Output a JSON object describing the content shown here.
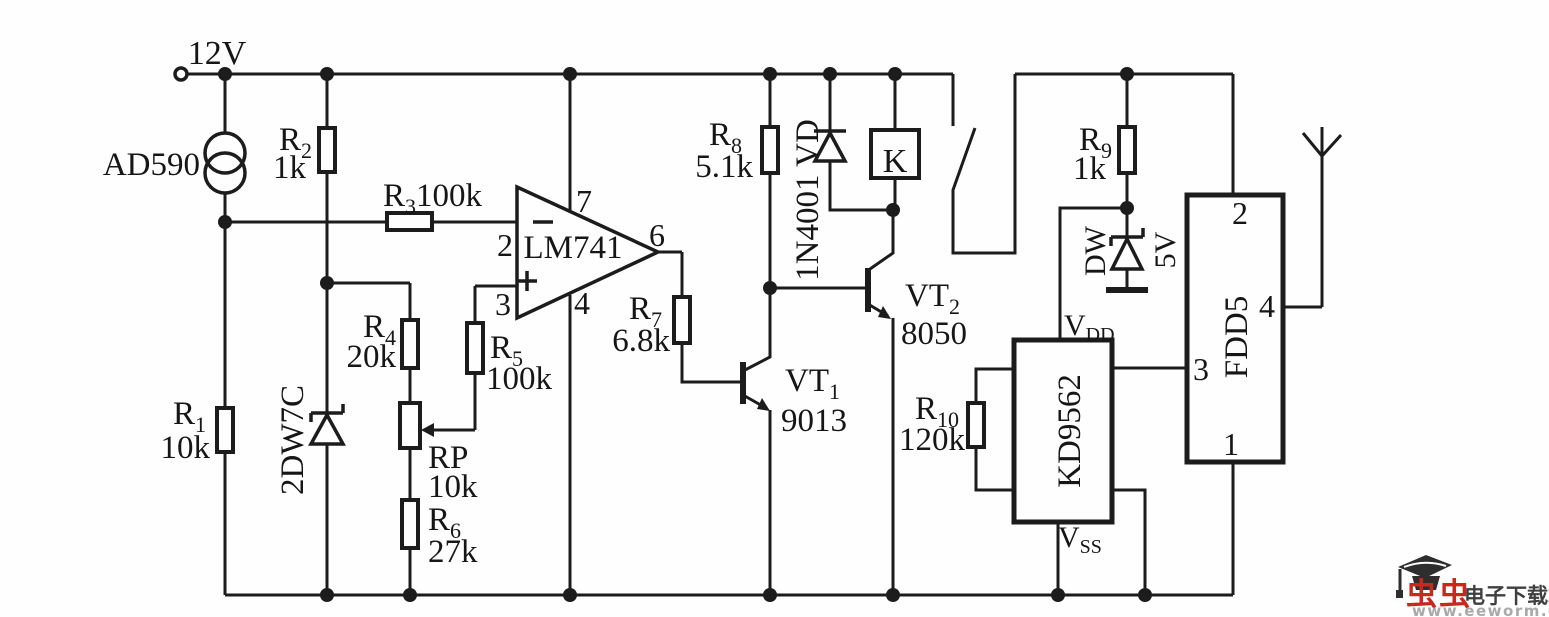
{
  "power": {
    "supply_label": "12V"
  },
  "sensor": {
    "label": "AD590"
  },
  "opamp": {
    "label": "LM741",
    "pin2": "2",
    "pin3": "3",
    "pin4": "4",
    "pin6": "6",
    "pin7": "7"
  },
  "resistors": {
    "r1": {
      "ref": "R",
      "sub": "1",
      "value": "10k"
    },
    "r2": {
      "ref": "R",
      "sub": "2",
      "value": "1k"
    },
    "r3": {
      "ref": "R",
      "sub": "3",
      "value": "100k"
    },
    "r4": {
      "ref": "R",
      "sub": "4",
      "value": "20k"
    },
    "r5": {
      "ref": "R",
      "sub": "5",
      "value": "100k"
    },
    "r6": {
      "ref": "R",
      "sub": "6",
      "value": "27k"
    },
    "r7": {
      "ref": "R",
      "sub": "7",
      "value": "6.8k"
    },
    "r8": {
      "ref": "R",
      "sub": "8",
      "value": "5.1k"
    },
    "r9": {
      "ref": "R",
      "sub": "9",
      "value": "1k"
    },
    "r10": {
      "ref": "R",
      "sub": "10",
      "value": "120k"
    },
    "rp": {
      "ref": "RP",
      "value": "10k"
    }
  },
  "diodes": {
    "zener_2dw7c": {
      "label": "2DW7C"
    },
    "vd_1n4001": {
      "label": "1N4001 VD"
    },
    "dw_zener": {
      "label": "DW",
      "value": "5V"
    }
  },
  "transistors": {
    "vt1": {
      "ref": "VT",
      "sub": "1",
      "model": "9013"
    },
    "vt2": {
      "ref": "VT",
      "sub": "2",
      "model": "8050"
    }
  },
  "relay": {
    "label": "K"
  },
  "ics": {
    "kd9562": {
      "label": "KD9562",
      "vdd_base": "V",
      "vdd_sub": "DD",
      "vss_base": "V",
      "vss_sub": "SS"
    },
    "fdd5": {
      "label": "FDD5",
      "pin1": "1",
      "pin2": "2",
      "pin3": "3",
      "pin4": "4"
    }
  },
  "watermark": {
    "brand": "虫虫",
    "site": "电子下载站",
    "url": "www.eeworm.com"
  }
}
